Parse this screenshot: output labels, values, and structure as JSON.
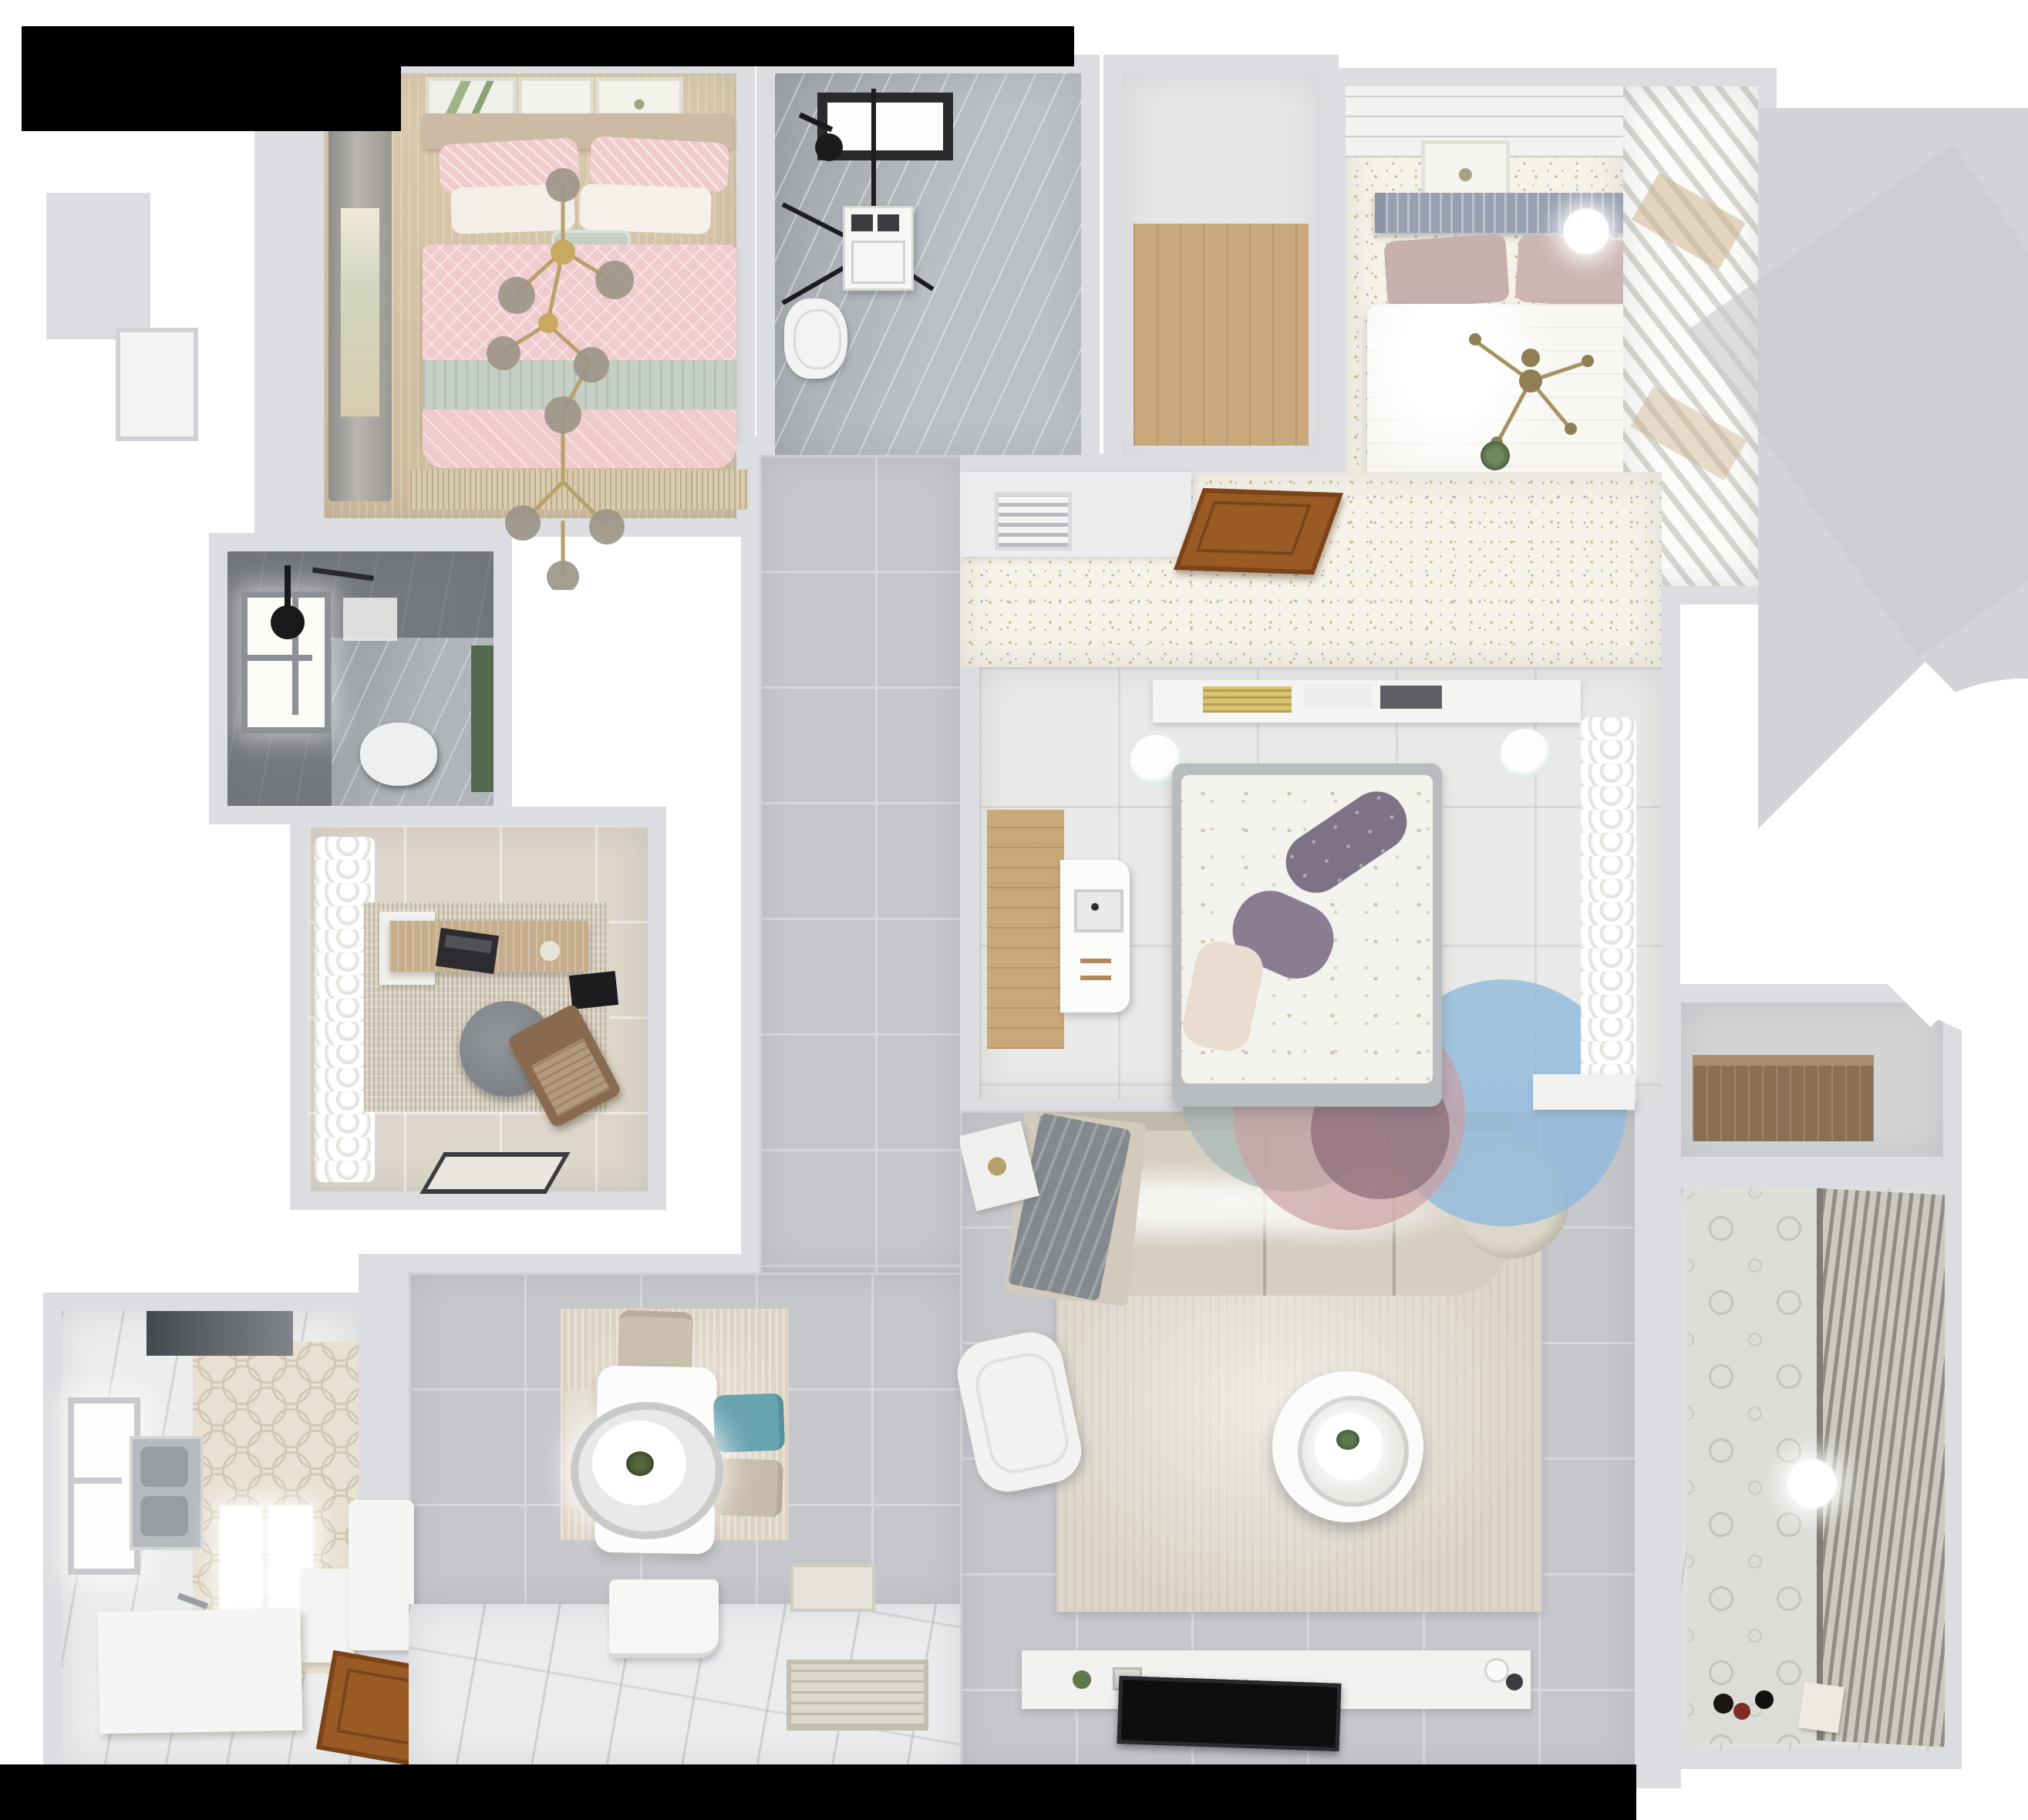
{
  "scene": {
    "label": "Top-down 3D render of a furnished apartment floor plan",
    "style": "photoreal dollhouse view, white and grey palette with pastel accents"
  },
  "colors": {
    "wall": "#dcdde0",
    "wall-light": "#e9eaed",
    "floor-tile": "#c6c7cb",
    "tile-line": "#d8d9dc",
    "speckle": "#f5f2e8",
    "speck-gold": "#cdbd85",
    "speck-blue": "#a3b7c2",
    "wood-mid": "#c9a87d",
    "wood-door": "#9a5a26",
    "hex": "#e8e1d2",
    "marble": "#bcc0c4",
    "dark-bath": "#75787d",
    "pink": "#f0cbcd",
    "sage": "#c6cfc6",
    "mauve": "#c7b0b0",
    "slate-headboard": "#97a1b2",
    "teal-chair": "#68a3b0",
    "sofa-beige": "#d6cfc1",
    "rug-beige": "#dcd6c9",
    "rug-blue": "#8fb9dc",
    "rug-pink": "#c99fa4",
    "rug-gray": "#a9b8b4",
    "rug-plum": "#8d6e79",
    "gold": "#b7a06a",
    "chair-brown": "#8a6a4e",
    "plant-green": "#53684f",
    "tv-black": "#0e0e10",
    "backdrop-black": "#000000",
    "backdrop-white": "#ffffff"
  },
  "rooms": [
    {
      "id": "bedroom-secondary",
      "label": "Secondary bedroom with pink bedding and gold branch chandelier"
    },
    {
      "id": "bathroom-main",
      "label": "Main bathroom with skylight, glass shower, washer and toilet"
    },
    {
      "id": "storage-room",
      "label": "Small storage room with wood floor"
    },
    {
      "id": "bedroom-master",
      "label": "Master bedroom with white bed on speckled floor"
    },
    {
      "id": "wardrobe-closet",
      "label": "Master closet with angled white shelving"
    },
    {
      "id": "bedroom-corridor",
      "label": "Master bedroom entry zone with AC vent and open wooden door"
    },
    {
      "id": "bathroom-shower",
      "label": "Dark tiled shower room with window and toilet"
    },
    {
      "id": "study",
      "label": "Study with desk, round chair, lounge chair and sheer curtains"
    },
    {
      "id": "kitchen",
      "label": "Kitchen with hex tile floor, double sink, hood and counters"
    },
    {
      "id": "dining-area",
      "label": "Dining area with white table, oval pendant and chairs"
    },
    {
      "id": "living-room",
      "label": "Living room with L-sofa, round coffee table, armchair and TV wall"
    },
    {
      "id": "utility-room",
      "label": "Utility niche with wooden counter"
    },
    {
      "id": "balcony",
      "label": "Balcony with patterned tile wall, blinds, ball lamp and toys"
    },
    {
      "id": "hallway",
      "label": "Central hallway with large grey tiles"
    },
    {
      "id": "entryway",
      "label": "Entryway with white tiles and doormats"
    },
    {
      "id": "bedroom-center",
      "label": "Middle bedroom with floral duvet, purple pillows and round rugs"
    }
  ],
  "furniture": [
    {
      "room": "bedroom-secondary",
      "items": [
        "double-bed-pink",
        "sage-throw",
        "gold-branch-chandelier",
        "three-wall-art-frames",
        "window-curtain",
        "fringe-rug"
      ]
    },
    {
      "room": "bathroom-main",
      "items": [
        "black-frame-shower",
        "skylight",
        "washing-machine",
        "toilet"
      ]
    },
    {
      "room": "bedroom-master",
      "items": [
        "double-bed-white",
        "slat-headboard",
        "mauve-pillows",
        "gold-cross-chandelier",
        "ceiling-light",
        "wall-art"
      ]
    },
    {
      "room": "bathroom-shower",
      "items": [
        "window",
        "ceiling-shower-head",
        "toilet",
        "green-cabinet"
      ]
    },
    {
      "room": "study",
      "items": [
        "wood-desk",
        "laptop",
        "round-gray-chair",
        "brown-lounge-chair",
        "mottled-rug",
        "doormat"
      ]
    },
    {
      "room": "kitchen",
      "items": [
        "range-hood",
        "double-sink",
        "l-counter",
        "wooden-door",
        "window"
      ]
    },
    {
      "room": "dining-area",
      "items": [
        "white-dining-table",
        "oval-pendant-lamp",
        "beige-chairs",
        "teal-chair",
        "bench",
        "tall-white-cabinet"
      ]
    },
    {
      "room": "living-room",
      "items": [
        "l-shaped-sofa",
        "gray-blanket",
        "round-coffee-table",
        "white-armchair",
        "side-table",
        "tv-console",
        "flat-tv"
      ]
    },
    {
      "room": "bedroom-center",
      "items": [
        "bed-floral-duvet",
        "purple-pillows",
        "headboard-shelf-books",
        "white-desk-imac",
        "two-stools",
        "overlapping-round-rugs",
        "sheer-curtains"
      ]
    },
    {
      "room": "balcony",
      "items": [
        "ball-lamp",
        "venetian-blinds",
        "toys"
      ]
    },
    {
      "room": "entryway",
      "items": [
        "white-entry-door",
        "doormat-small",
        "doormat-patterned"
      ]
    }
  ]
}
